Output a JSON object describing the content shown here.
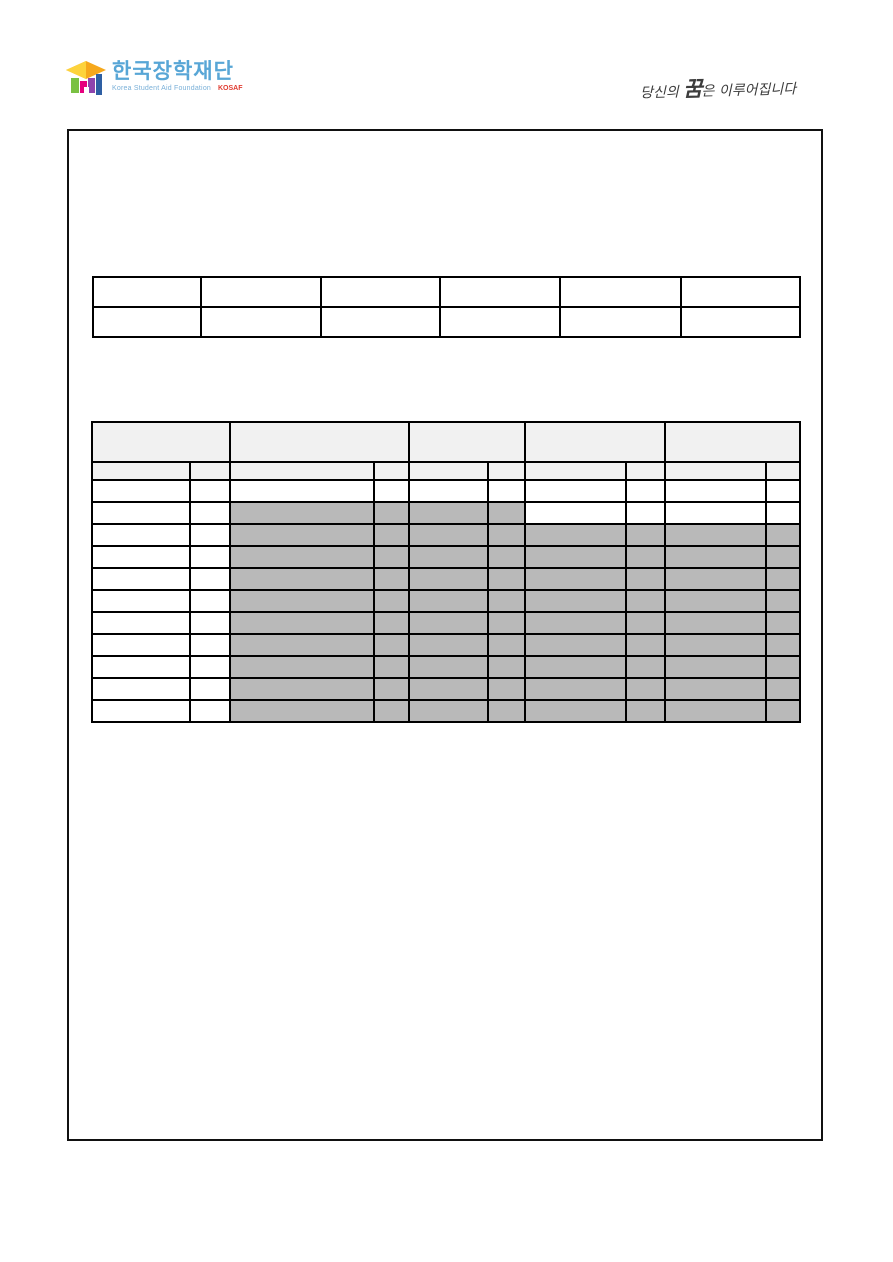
{
  "header": {
    "logo": {
      "korean_name": "한국장학재단",
      "subtext": "Korea Student Aid Foundation",
      "acronym": "KOSAF"
    },
    "slogan": {
      "prefix": "당신의 ",
      "emphasis": "꿈",
      "suffix": "은 이루어집니다"
    }
  },
  "colors": {
    "logo_text_blue": "#58a6d6",
    "kosaf_red": "#e03c31",
    "slogan_ink": "#3c3c3c",
    "table_border": "#000000",
    "table_header_fill": "#f1f1f1",
    "table_shaded_fill": "#b9b9b9"
  },
  "upper_table": {
    "columns": 6,
    "rows": 2,
    "cells_empty": true
  },
  "lower_table": {
    "column_groups": 5,
    "subcolumns_per_group": 2,
    "header_rows": 2,
    "data_rows": 11,
    "cells_empty": true,
    "rows_shaded_groups": [
      [],
      [
        2,
        3
      ],
      [
        2,
        3,
        4,
        5
      ],
      [
        2,
        3,
        4,
        5
      ],
      [
        2,
        3,
        4,
        5
      ],
      [
        2,
        3,
        4,
        5
      ],
      [
        2,
        3,
        4,
        5
      ],
      [
        2,
        3,
        4,
        5
      ],
      [
        2,
        3,
        4,
        5
      ],
      [
        2,
        3,
        4,
        5
      ],
      [
        2,
        3,
        4,
        5
      ]
    ]
  }
}
